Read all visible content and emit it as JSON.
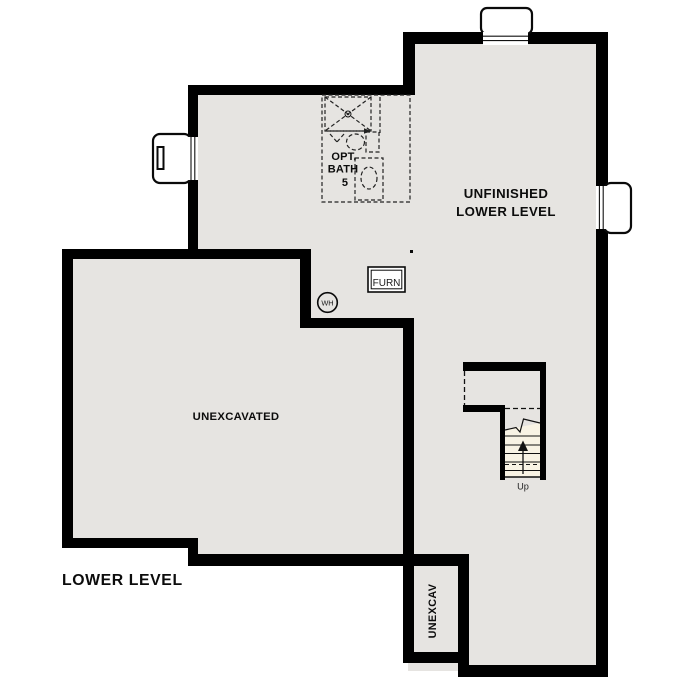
{
  "plan": {
    "title": "LOWER LEVEL",
    "labels": {
      "unfinished_line1": "UNFINISHED",
      "unfinished_line2": "LOWER LEVEL",
      "unexcavated": "UNEXCAVATED",
      "unexcav_small": "UNEXCAV",
      "opt_bath_line1": "OPT.",
      "opt_bath_line2": "BATH",
      "opt_bath_line3": "5",
      "furnace": "FURN",
      "water_heater": "WH",
      "stairs_up": "Up"
    },
    "colors": {
      "background": "#ffffff",
      "floor": "#e6e4e1",
      "wall": "#000000",
      "stair_tread": "#f8f3e4",
      "line": "#111111"
    }
  }
}
